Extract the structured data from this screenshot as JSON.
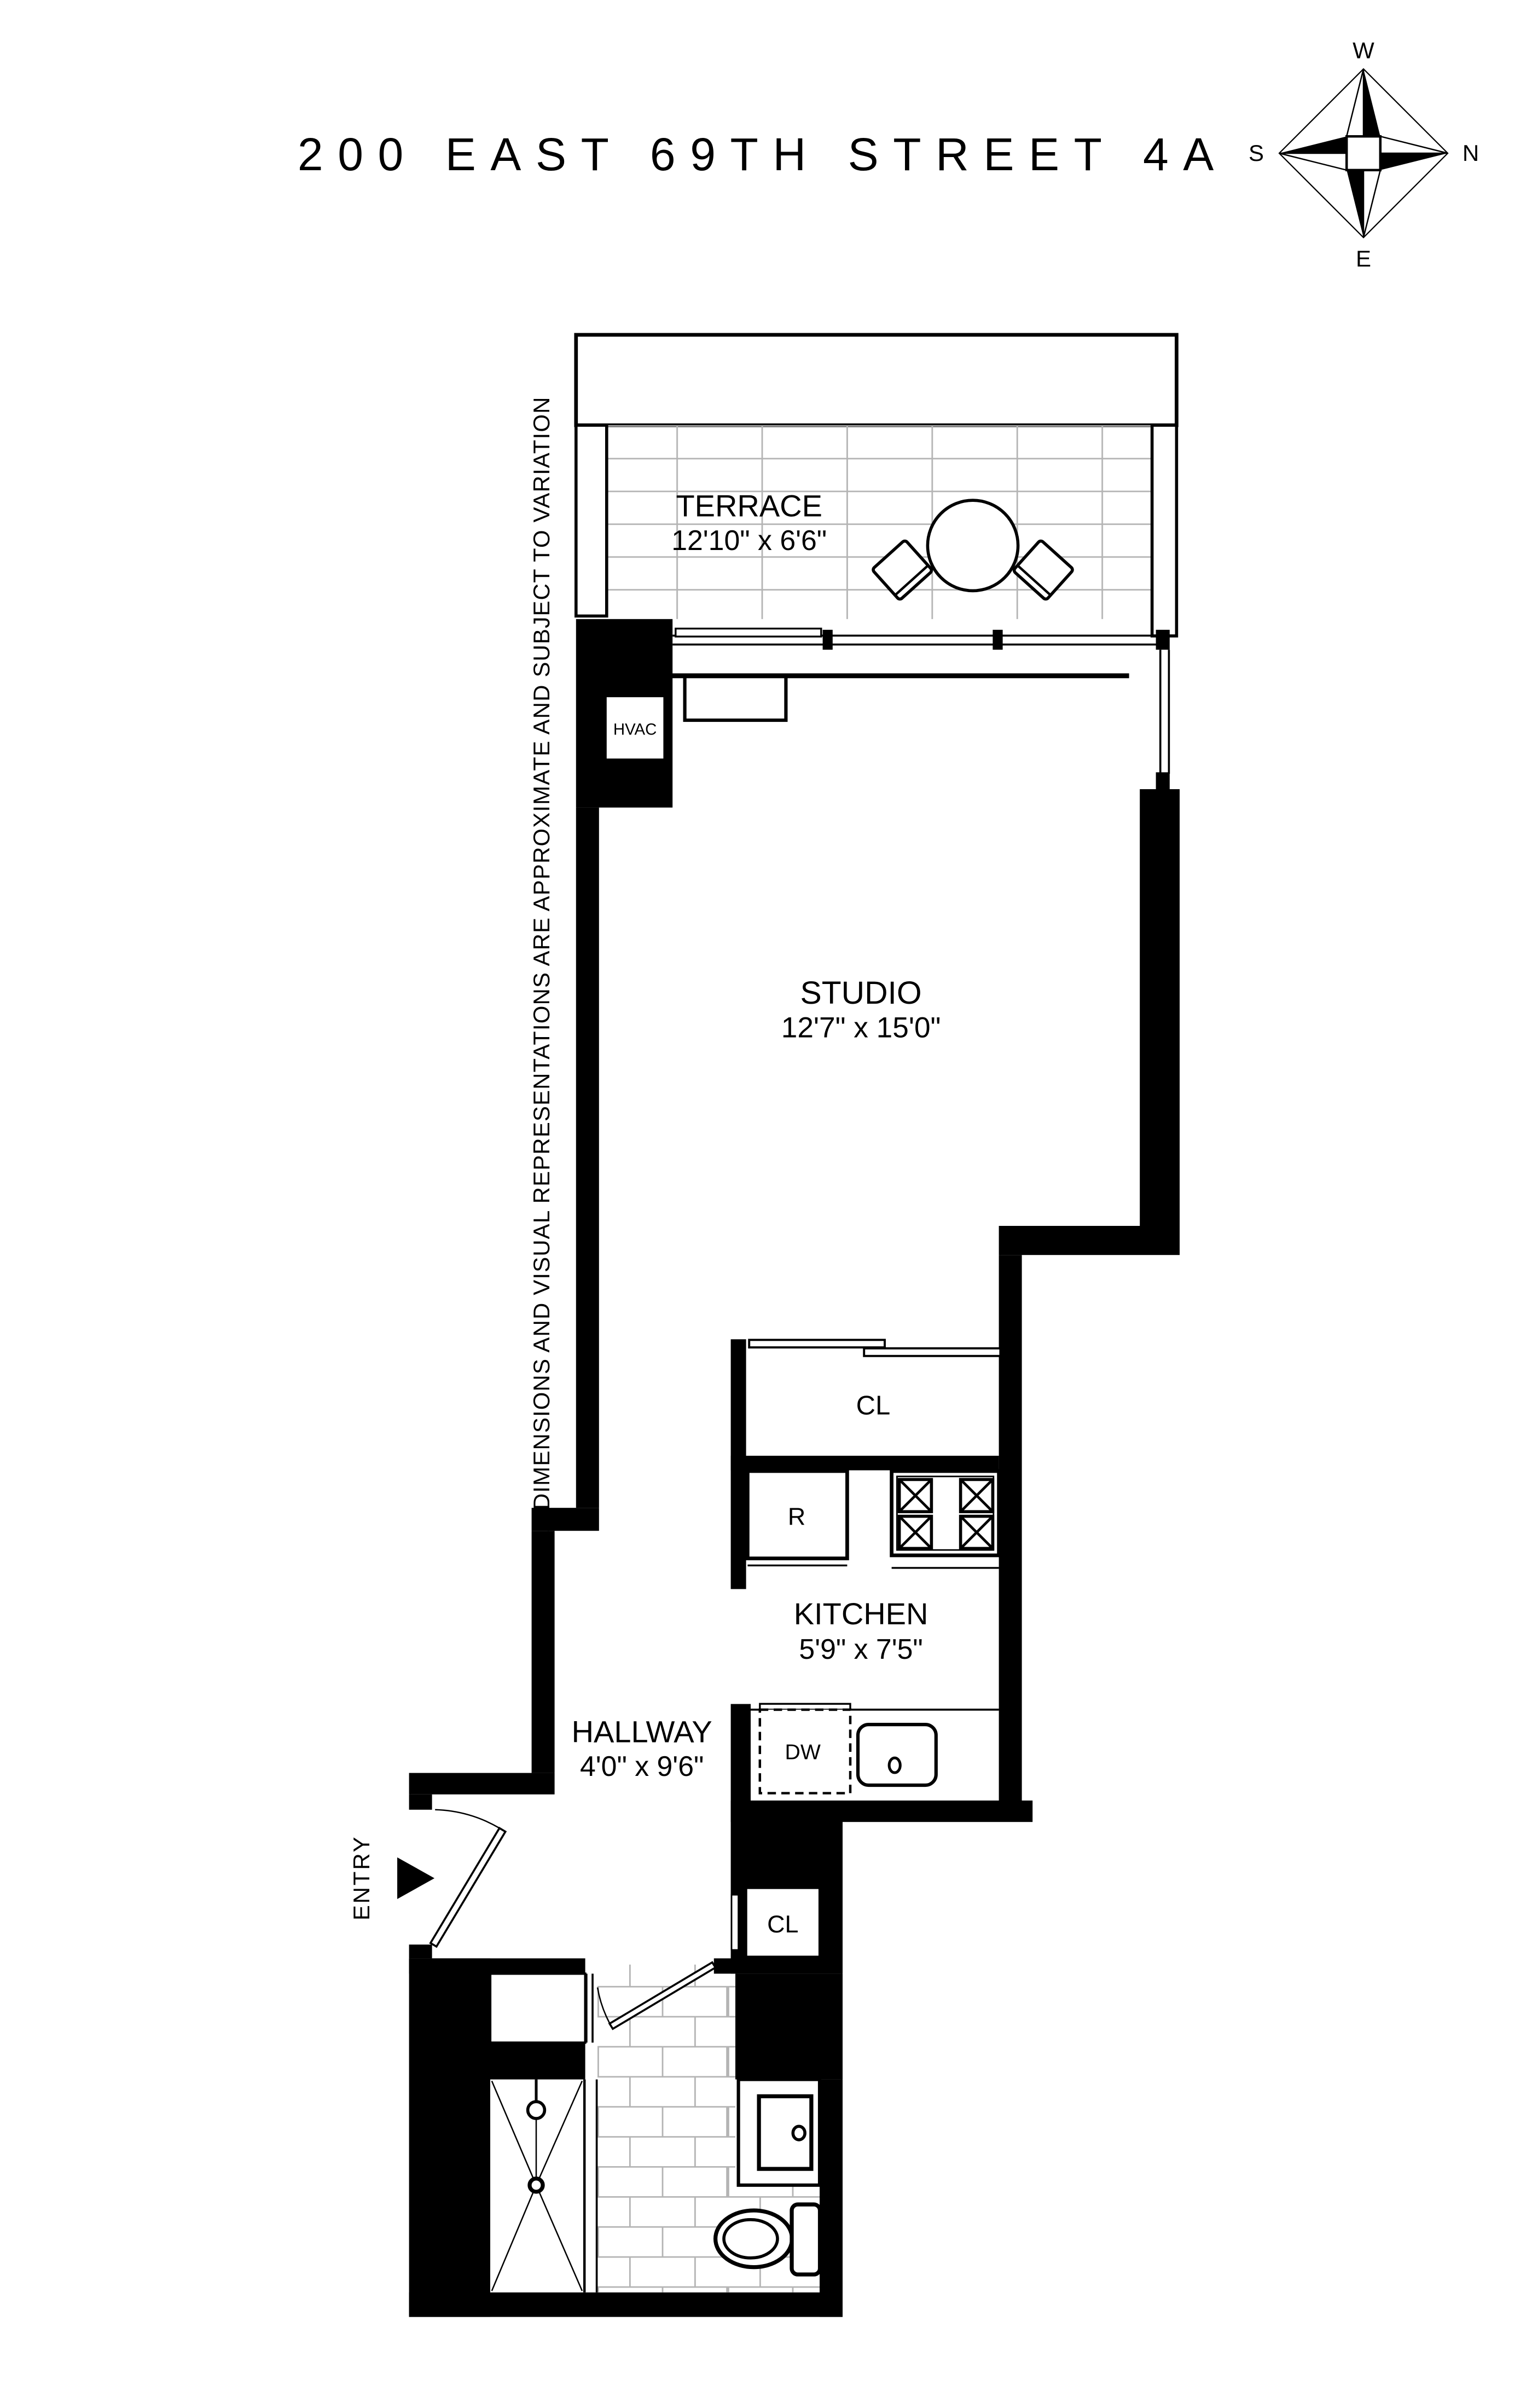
{
  "title": "200 EAST 69TH STREET 4A",
  "disclaimer": "ALL DIMENSIONS AND VISUAL REPRESENTATIONS ARE APPROXIMATE AND SUBJECT TO VARIATION",
  "compass": {
    "top": "W",
    "right": "N",
    "bottom": "E",
    "left": "S"
  },
  "rooms": {
    "terrace": {
      "name": "TERRACE",
      "dims": "12'10\" x 6'6\""
    },
    "studio": {
      "name": "STUDIO",
      "dims": "12'7\" x 15'0\""
    },
    "kitchen": {
      "name": "KITCHEN",
      "dims": "5'9\" x 7'5\""
    },
    "hallway": {
      "name": "HALLWAY",
      "dims": "4'0\" x 9'6\""
    },
    "entry": {
      "name": "ENTRY"
    },
    "closet_upper": {
      "label": "CL"
    },
    "closet_lower": {
      "label": "CL"
    }
  },
  "appliances": {
    "hvac": "HVAC",
    "refrigerator": "R",
    "dishwasher": "DW"
  },
  "icons": {
    "compass_rose": "compass-rose-icon",
    "round_table": "round-table-icon",
    "chairs": "chair-icon",
    "stove": "stove-burners-icon",
    "kitchen_sink": "kitchen-sink-icon",
    "bath_vanity": "vanity-sink-icon",
    "toilet": "toilet-icon",
    "shower": "shower-icon",
    "entry_arrow": "entry-arrow-icon"
  },
  "colors": {
    "wall": "#000000",
    "floor": "#ffffff",
    "tile_line": "#b4b4b4",
    "text": "#000000"
  }
}
